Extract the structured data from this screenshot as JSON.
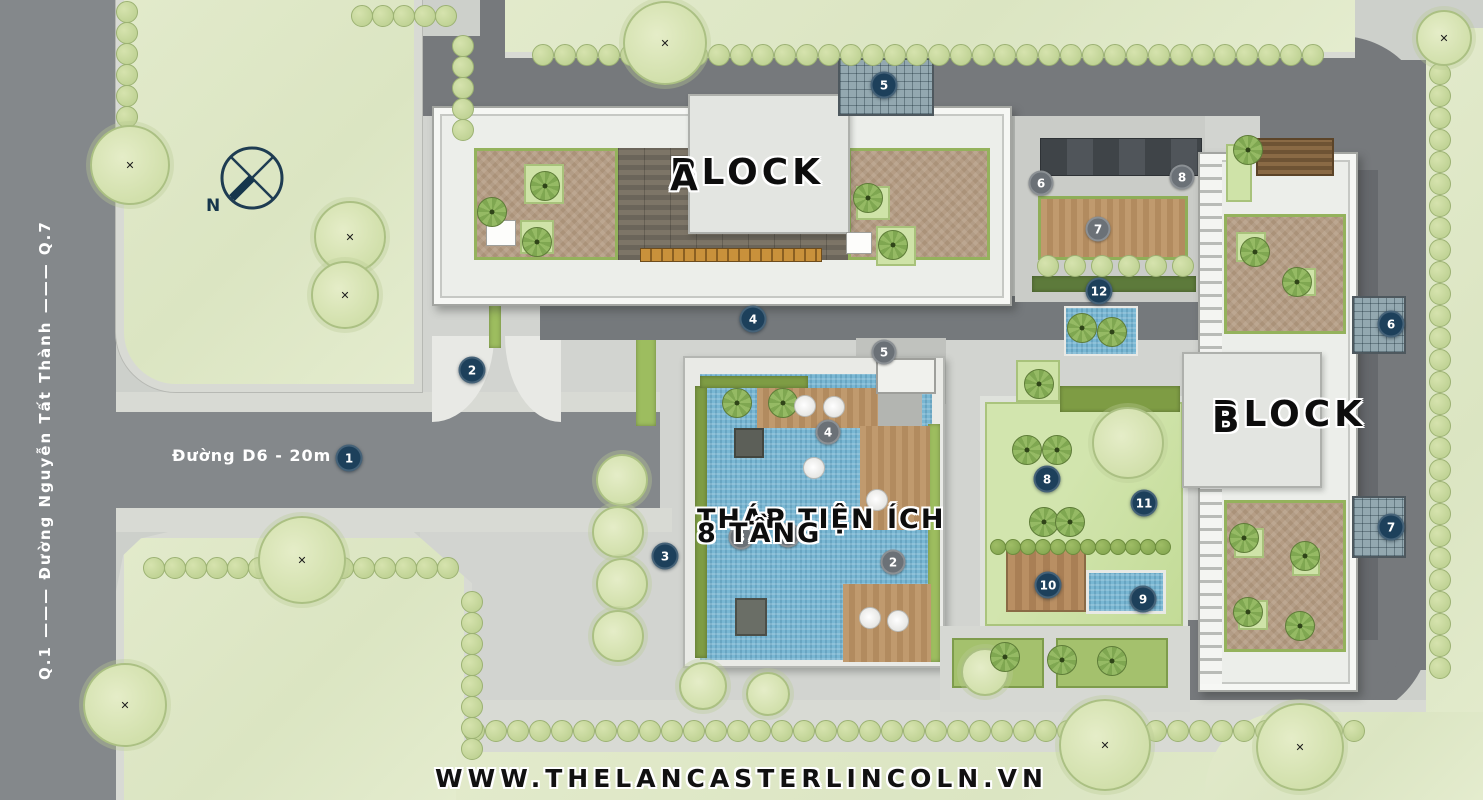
{
  "labels": {
    "block_a_line1": "BLOCK",
    "block_a_line2": "A",
    "block_b_line1": "BLOCK",
    "block_b_line2": "B",
    "amenity_line1": "THÁP TIỆN ÍCH",
    "amenity_line2": "8 TẦNG",
    "road_d6": "Đường D6 - 20m",
    "road_left": "Q.1 ——— Đường Nguyễn Tất Thành ——— Q.7",
    "compass_n": "N",
    "website": "WWW.THELANCASTERLINCOLN.VN"
  },
  "colors": {
    "marker_navy": "#1d405b",
    "marker_gray": "#6b7177",
    "road": "#84888b",
    "lawn": "#dfe8ca",
    "tree": "#c9daa5",
    "pool": "#79b7d3",
    "wood_deck": "#b98f63",
    "hedge": "#7e9c44",
    "building": "#eceeea"
  },
  "markers": [
    {
      "n": "1",
      "x": 349,
      "y": 458,
      "type": "navy"
    },
    {
      "n": "2",
      "x": 472,
      "y": 370,
      "type": "navy"
    },
    {
      "n": "3",
      "x": 665,
      "y": 556,
      "type": "navy"
    },
    {
      "n": "4",
      "x": 753,
      "y": 319,
      "type": "navy"
    },
    {
      "n": "5",
      "x": 884,
      "y": 85,
      "type": "navy"
    },
    {
      "n": "12",
      "x": 1099,
      "y": 291,
      "type": "navy"
    },
    {
      "n": "8",
      "x": 1047,
      "y": 479,
      "type": "navy"
    },
    {
      "n": "11",
      "x": 1144,
      "y": 503,
      "type": "navy"
    },
    {
      "n": "10",
      "x": 1048,
      "y": 585,
      "type": "navy"
    },
    {
      "n": "9",
      "x": 1143,
      "y": 599,
      "type": "navy"
    },
    {
      "n": "6",
      "x": 1391,
      "y": 324,
      "type": "navy"
    },
    {
      "n": "7",
      "x": 1391,
      "y": 527,
      "type": "navy"
    },
    {
      "n": "6",
      "x": 1041,
      "y": 183,
      "type": "gray"
    },
    {
      "n": "7",
      "x": 1098,
      "y": 229,
      "type": "gray"
    },
    {
      "n": "8",
      "x": 1182,
      "y": 177,
      "type": "gray"
    },
    {
      "n": "5",
      "x": 884,
      "y": 352,
      "type": "gray"
    },
    {
      "n": "4",
      "x": 828,
      "y": 432,
      "type": "gray"
    },
    {
      "n": "3",
      "x": 741,
      "y": 537,
      "type": "gray"
    },
    {
      "n": "1",
      "x": 788,
      "y": 535,
      "type": "gray"
    },
    {
      "n": "2",
      "x": 893,
      "y": 562,
      "type": "gray"
    }
  ],
  "decor": {
    "tree_rows": [
      {
        "x": 127,
        "y": 12,
        "dx": 0,
        "dy": 21,
        "n": 6
      },
      {
        "x": 362,
        "y": 16,
        "dx": 21,
        "dy": 0,
        "n": 5
      },
      {
        "x": 463,
        "y": 46,
        "dx": 0,
        "dy": 21,
        "n": 5
      },
      {
        "x": 543,
        "y": 55,
        "dx": 22,
        "dy": 0,
        "n": 36
      },
      {
        "x": 1440,
        "y": 74,
        "dx": 0,
        "dy": 22,
        "n": 28
      },
      {
        "x": 474,
        "y": 731,
        "dx": 22,
        "dy": 0,
        "n": 41
      },
      {
        "x": 154,
        "y": 568,
        "dx": 21,
        "dy": 0,
        "n": 15
      },
      {
        "x": 472,
        "y": 602,
        "dx": 0,
        "dy": 21,
        "n": 8
      },
      {
        "x": 1048,
        "y": 266,
        "dx": 27,
        "dy": 0,
        "n": 6
      },
      {
        "x": 998,
        "y": 547,
        "dx": 15,
        "dy": 0,
        "n": 12,
        "r": 8,
        "dark": true
      }
    ],
    "big_trees": [
      {
        "x": 130,
        "y": 165,
        "r": 40,
        "mark": true
      },
      {
        "x": 350,
        "y": 237,
        "r": 36,
        "mark": true
      },
      {
        "x": 345,
        "y": 295,
        "r": 34,
        "mark": true
      },
      {
        "x": 665,
        "y": 43,
        "r": 42,
        "mark": true
      },
      {
        "x": 302,
        "y": 560,
        "r": 44,
        "mark": true
      },
      {
        "x": 125,
        "y": 705,
        "r": 42,
        "mark": true
      },
      {
        "x": 1105,
        "y": 745,
        "r": 46,
        "mark": true
      },
      {
        "x": 1300,
        "y": 747,
        "r": 44,
        "mark": true
      },
      {
        "x": 1444,
        "y": 38,
        "r": 28,
        "mark": true
      },
      {
        "x": 622,
        "y": 480,
        "r": 26,
        "mark": false
      },
      {
        "x": 618,
        "y": 532,
        "r": 26,
        "mark": false
      },
      {
        "x": 622,
        "y": 584,
        "r": 26,
        "mark": false
      },
      {
        "x": 618,
        "y": 636,
        "r": 26,
        "mark": false
      },
      {
        "x": 703,
        "y": 686,
        "r": 24,
        "mark": false
      },
      {
        "x": 768,
        "y": 694,
        "r": 22,
        "mark": false
      },
      {
        "x": 985,
        "y": 672,
        "r": 24,
        "mark": false
      },
      {
        "x": 1128,
        "y": 443,
        "r": 36,
        "mark": false
      }
    ],
    "pin_trees": [
      {
        "x": 737,
        "y": 403
      },
      {
        "x": 783,
        "y": 403
      },
      {
        "x": 1027,
        "y": 450
      },
      {
        "x": 1057,
        "y": 450
      },
      {
        "x": 1044,
        "y": 522
      },
      {
        "x": 1070,
        "y": 522
      },
      {
        "x": 1005,
        "y": 657
      },
      {
        "x": 1062,
        "y": 660
      },
      {
        "x": 1112,
        "y": 661
      },
      {
        "x": 545,
        "y": 186
      },
      {
        "x": 537,
        "y": 242
      },
      {
        "x": 492,
        "y": 212
      },
      {
        "x": 868,
        "y": 198
      },
      {
        "x": 893,
        "y": 245
      },
      {
        "x": 1248,
        "y": 150
      },
      {
        "x": 1255,
        "y": 252
      },
      {
        "x": 1297,
        "y": 282
      },
      {
        "x": 1244,
        "y": 538
      },
      {
        "x": 1305,
        "y": 556
      },
      {
        "x": 1248,
        "y": 612
      },
      {
        "x": 1300,
        "y": 626
      },
      {
        "x": 1039,
        "y": 384
      },
      {
        "x": 1082,
        "y": 328
      },
      {
        "x": 1112,
        "y": 332
      }
    ],
    "umbrellas": [
      {
        "x": 805,
        "y": 406
      },
      {
        "x": 834,
        "y": 407
      },
      {
        "x": 814,
        "y": 468
      },
      {
        "x": 877,
        "y": 500
      },
      {
        "x": 870,
        "y": 618
      },
      {
        "x": 898,
        "y": 621
      }
    ]
  }
}
